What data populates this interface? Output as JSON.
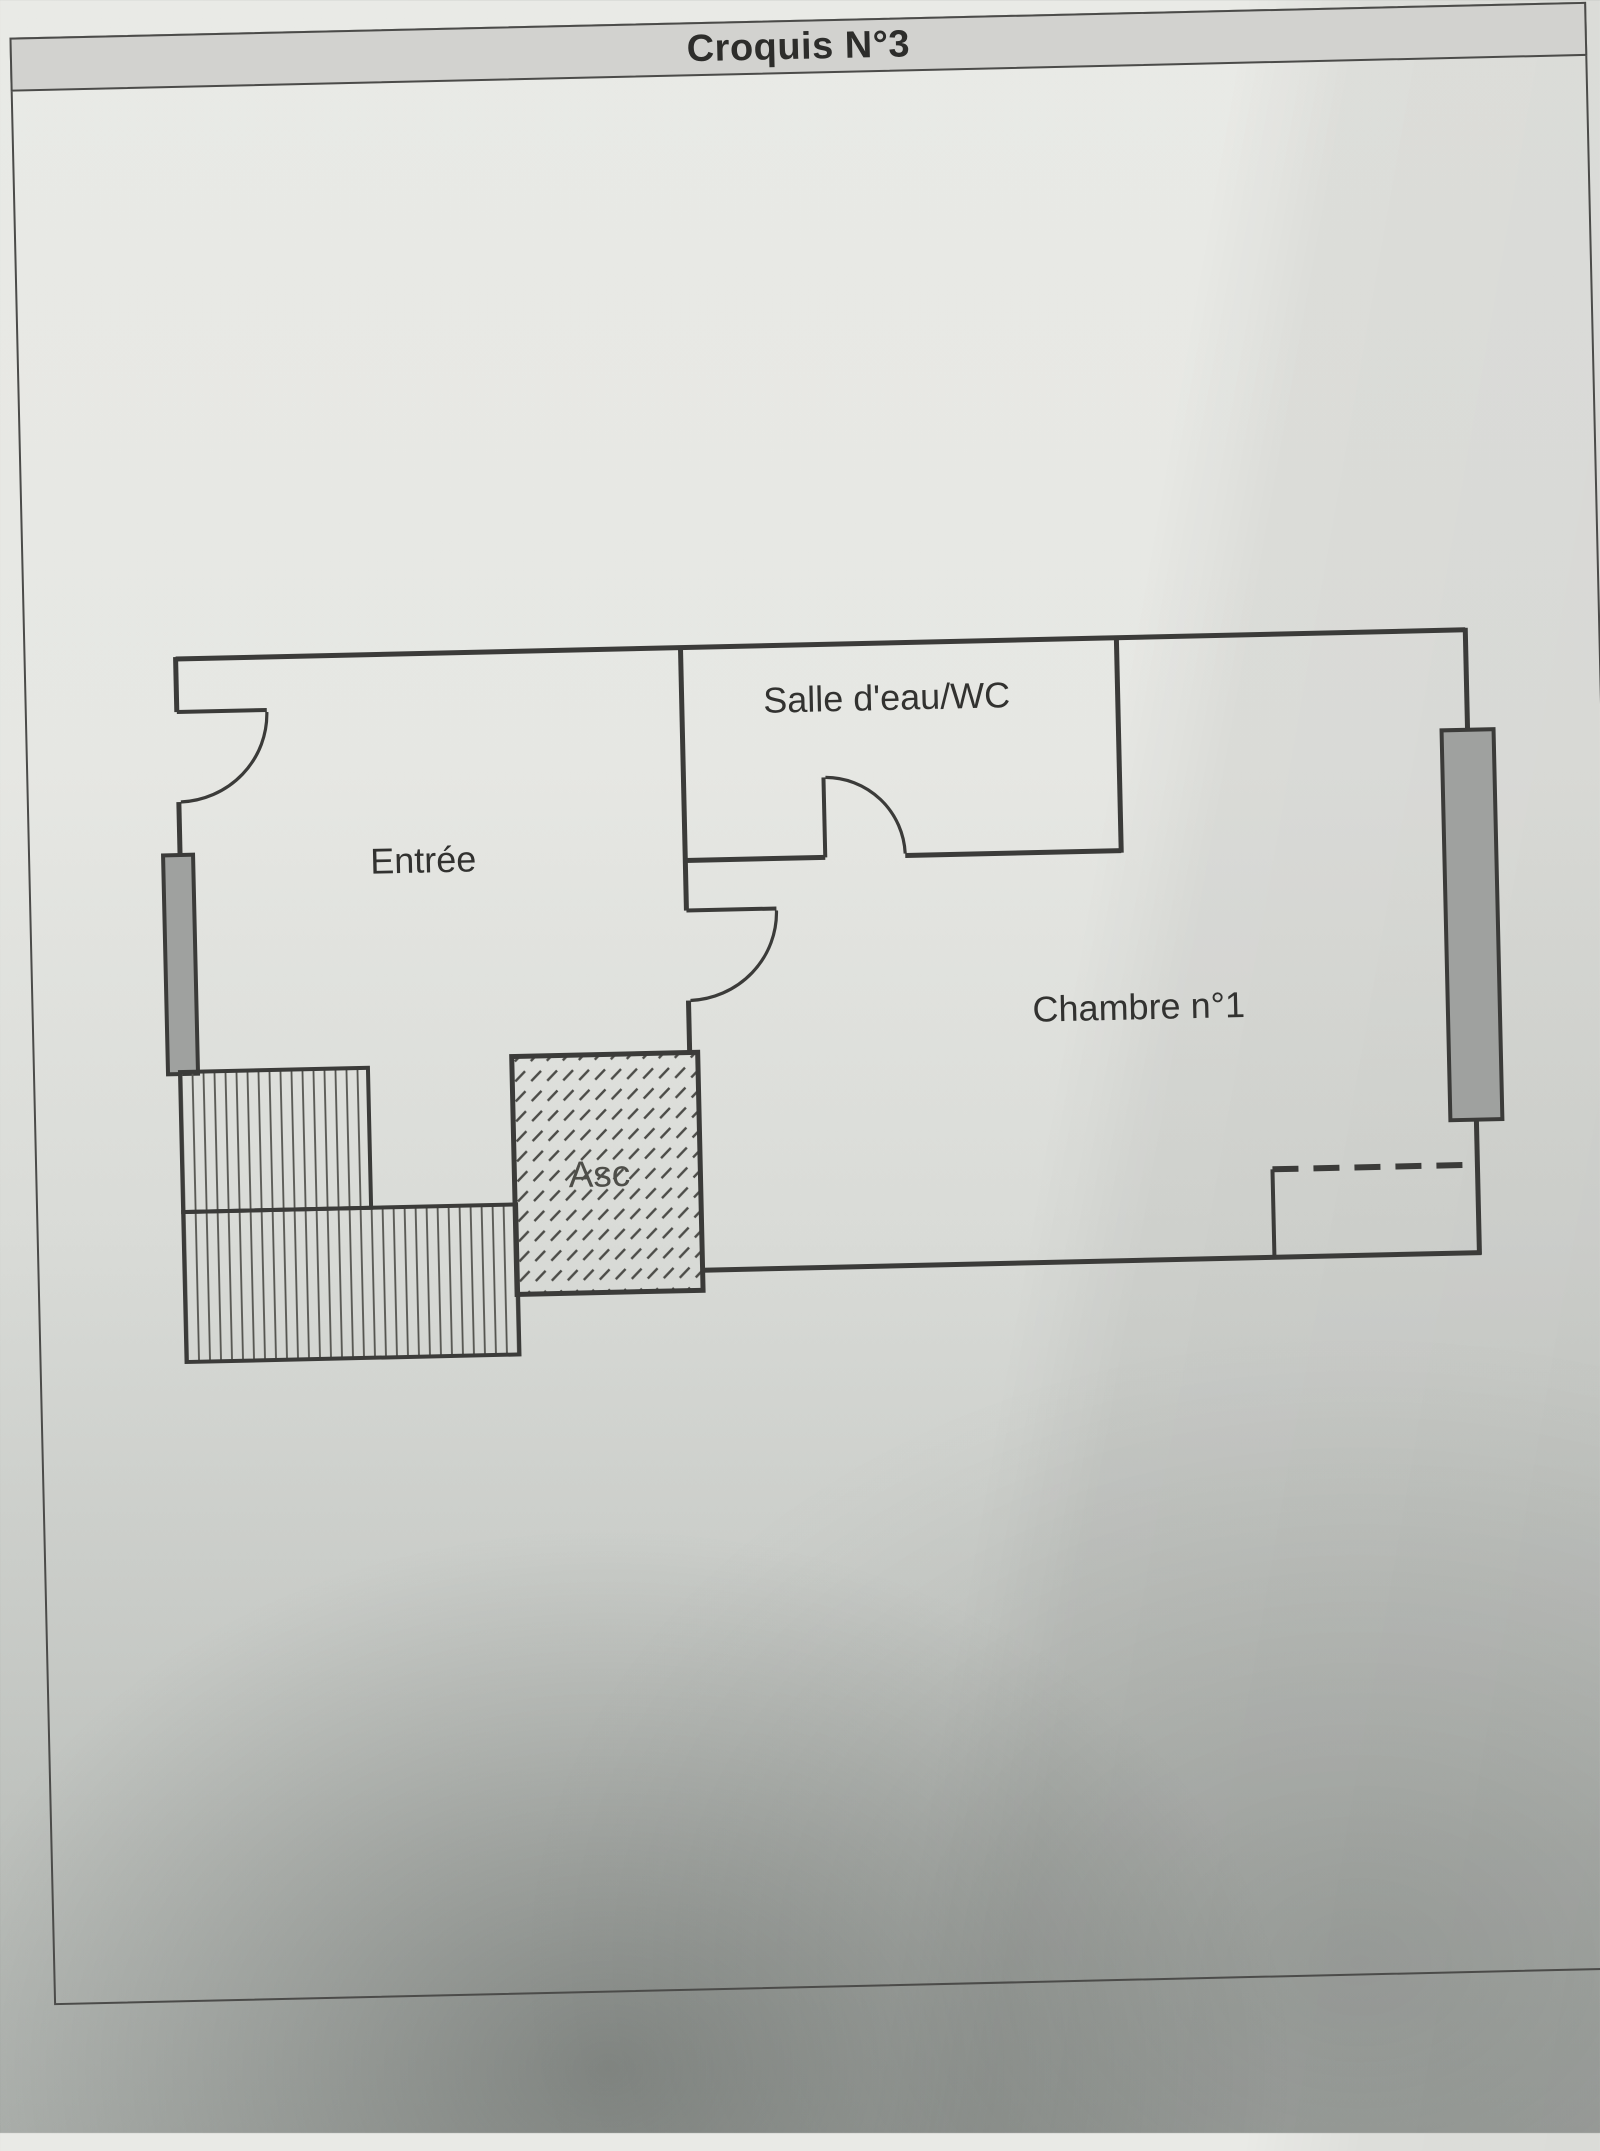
{
  "document": {
    "title": "Croquis N°3"
  },
  "rooms": {
    "entree": "Entrée",
    "salle_eau": "Salle d'eau/WC",
    "chambre": "Chambre n°1",
    "ascenseur": "Asc"
  },
  "plan_features": {
    "doors": [
      "entrance-door",
      "bathroom-door",
      "bedroom-passage-door"
    ],
    "windows": [
      "left-wall-window",
      "right-wall-window"
    ],
    "stairs": "staircase-two-flights",
    "elevator": "hatched-shaft",
    "closet": "dashed-outline-bottom-right"
  },
  "colors": {
    "ink": "#3b3b39",
    "paper_top": "#e9eae6",
    "paper_bottom": "#aeb2ae",
    "header_fill": "#d2d2cf",
    "window_fill": "#9fa19f",
    "label_text": "#323230",
    "title_text": "#2d2d2b"
  }
}
